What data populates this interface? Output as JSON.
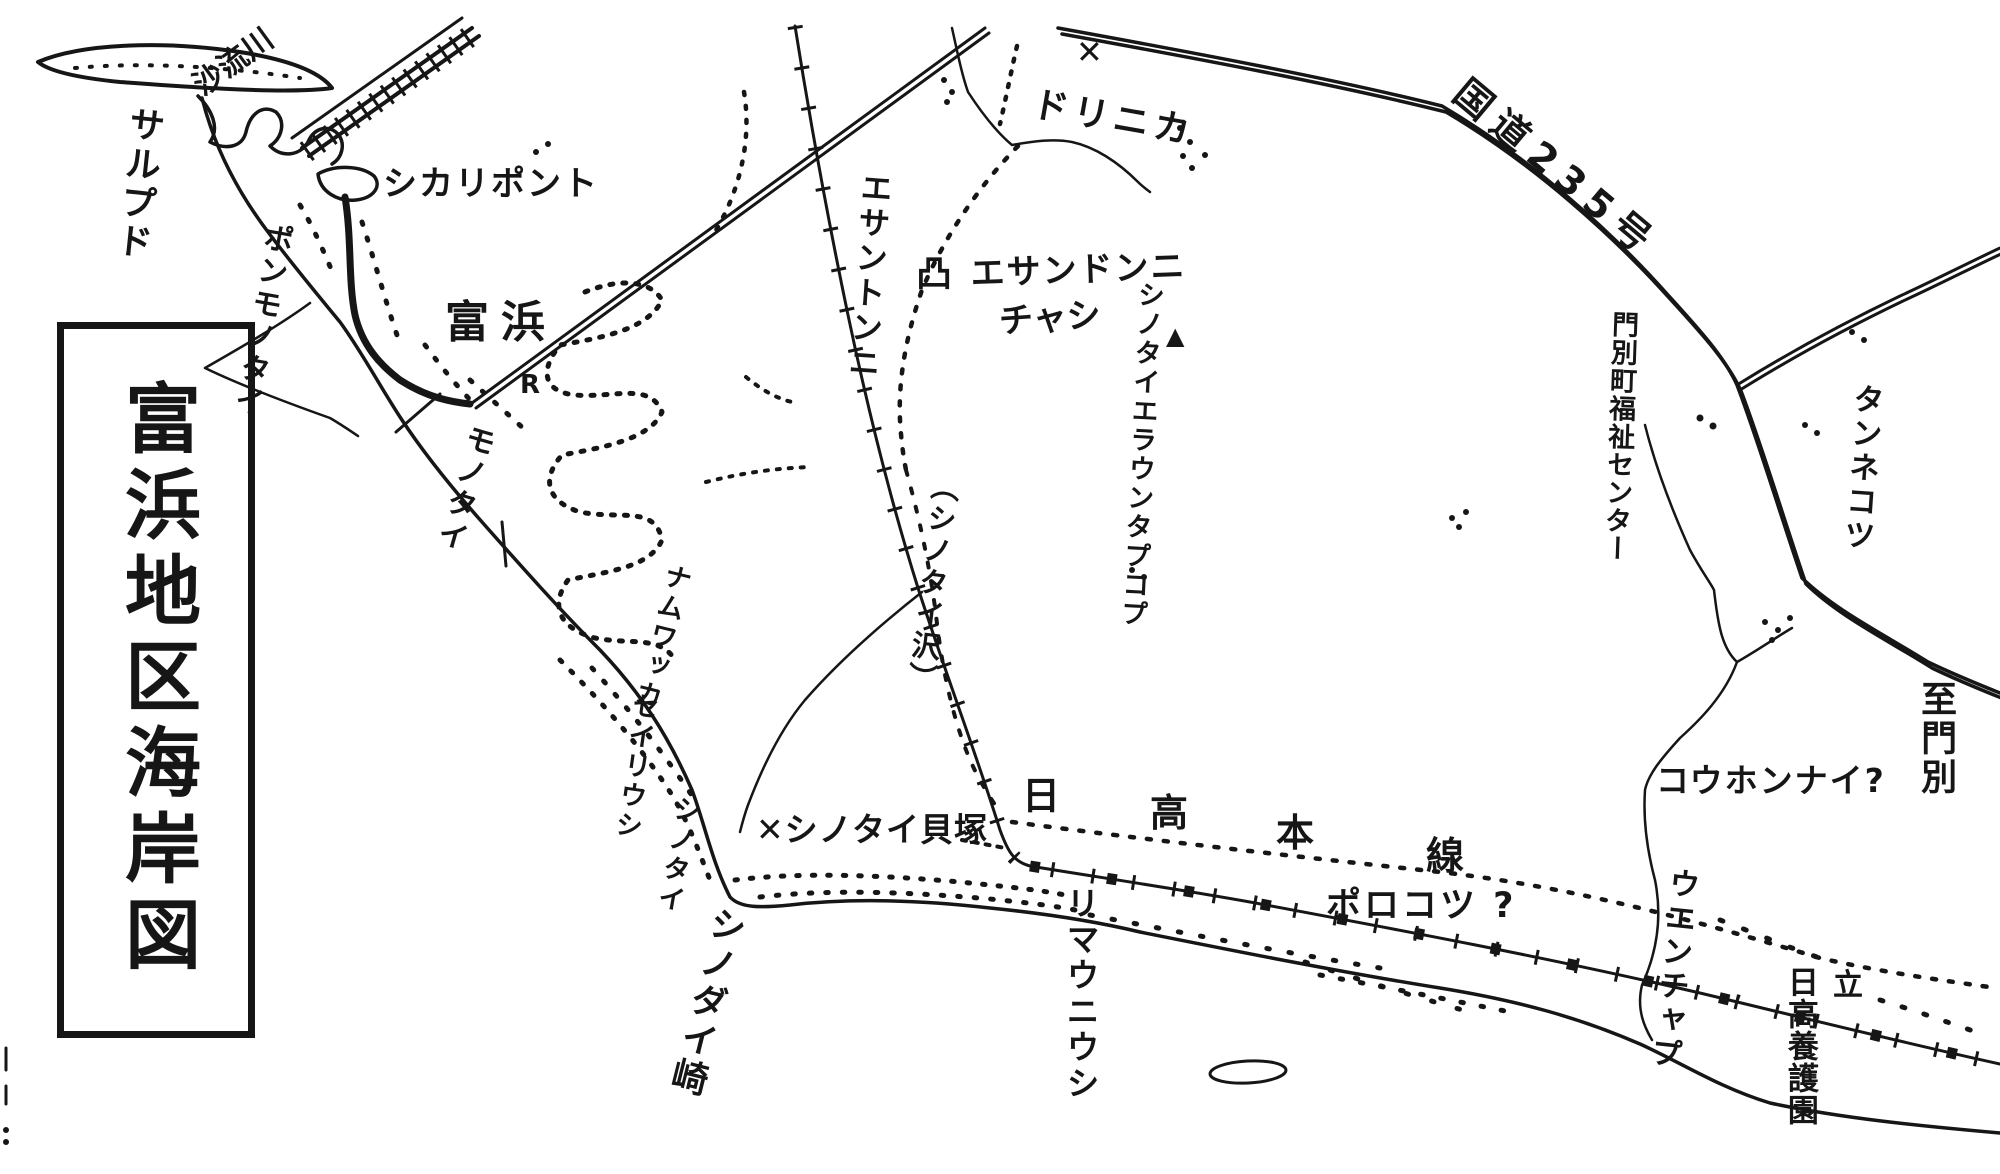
{
  "colors": {
    "ink": "#161616",
    "paper": "#ffffff"
  },
  "title": "富浜地区海岸図",
  "labels": {
    "saru_river": "沙流川",
    "sarupudo": "サルプド",
    "shikari_ponto": "シカリポント",
    "ponmonotai": "ポンモノタイ",
    "tomihama": "富浜",
    "monotai": "モノタイ",
    "r_mark": "R",
    "esantonni_vertical": "エサントンニ",
    "chashi_symbol": "凸",
    "esandonni": "エサンドンニ",
    "chashi": "チャシ",
    "x_mark": "✕",
    "dorinika": "ドリニカ",
    "hill_triangle": "▲",
    "shinotai_tapkop": "シノタイエラウンタプコプ",
    "shinotai_sawa": "（シノタイ沢）",
    "kokudo_235": "国道235号",
    "monbetsu_fukushi_center": "門別町福祉センター",
    "tannekotsu": "タンネコツ",
    "itaru_monbetsu": "至門別",
    "kouhonnai": "コウホンナイ?",
    "namuwakka": "ナムワッカ",
    "seiriushi": "セイリウシ",
    "shinotai": "シノタイ",
    "shinotai_kaizuka": "✕シノタイ貝塚",
    "shinodai_saki": "シノダイ崎",
    "rimauniushi": "リマウニウシ",
    "hidaka_honsen": [
      "日",
      "高",
      "本",
      "線"
    ],
    "porokotsu": "ポロコツ ?",
    "uenchap": "ウエンチャプ",
    "tatsu": "立",
    "hidaka_en": "日高養護園"
  }
}
